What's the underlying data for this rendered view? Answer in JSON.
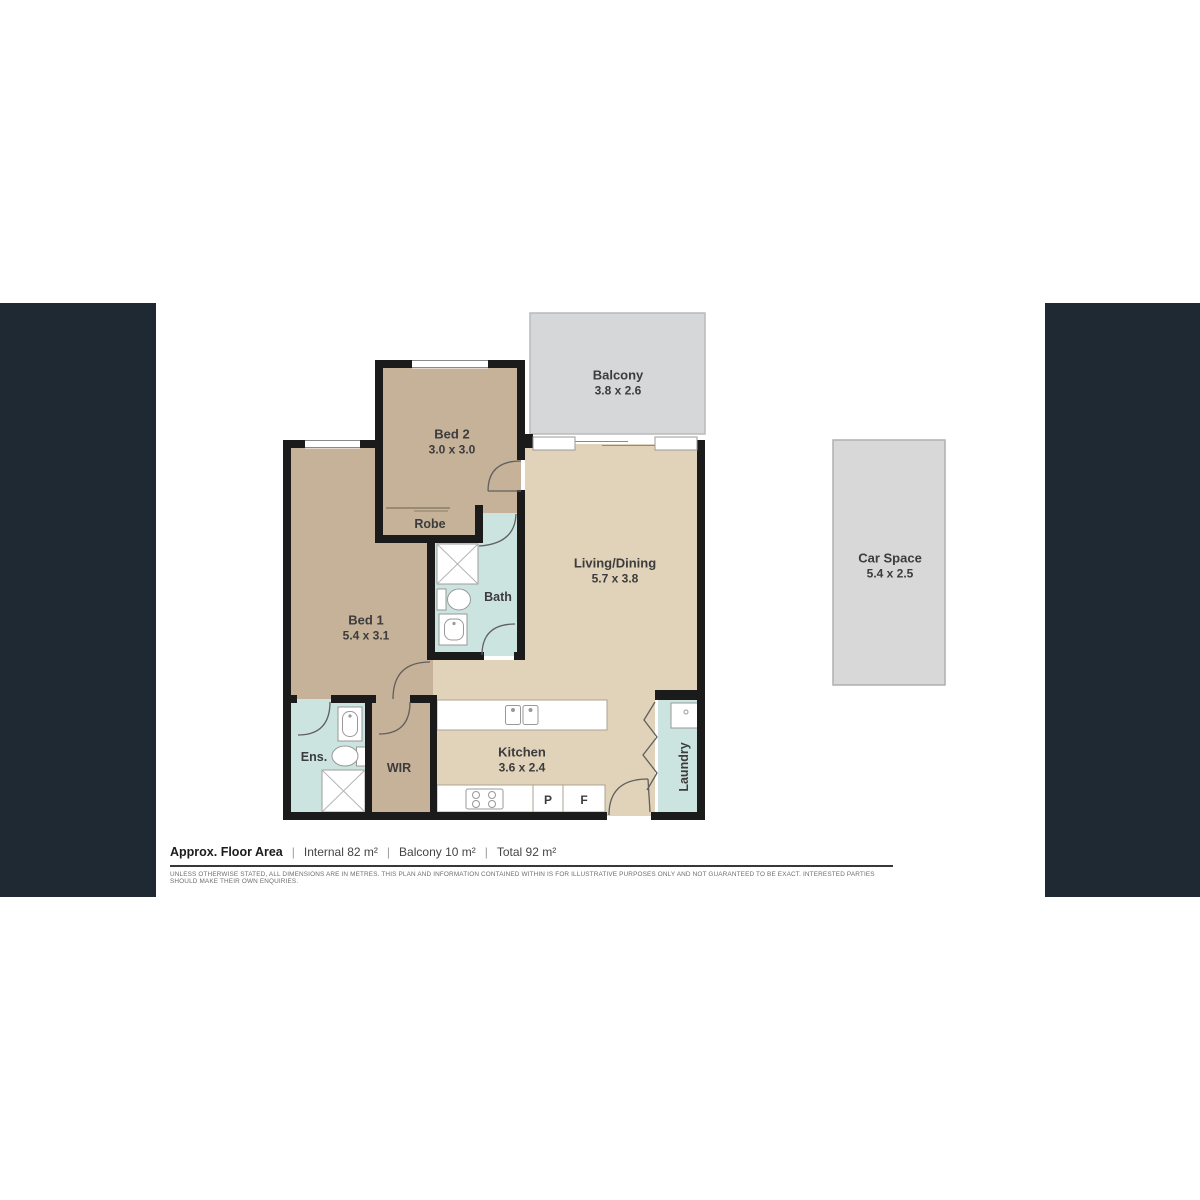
{
  "plan": {
    "rooms": {
      "bed1": {
        "name": "Bed 1",
        "dims": "5.4 x 3.1"
      },
      "bed2": {
        "name": "Bed 2",
        "dims": "3.0 x 3.0"
      },
      "living_dining": {
        "name": "Living/Dining",
        "dims": "5.7 x 3.8"
      },
      "kitchen": {
        "name": "Kitchen",
        "dims": "3.6 x 2.4"
      },
      "balcony": {
        "name": "Balcony",
        "dims": "3.8 x 2.6"
      },
      "car_space": {
        "name": "Car Space",
        "dims": "5.4 x 2.5"
      },
      "bath": {
        "name": "Bath"
      },
      "ensuite": {
        "name": "Ens."
      },
      "wir": {
        "name": "WIR"
      },
      "robe": {
        "name": "Robe"
      },
      "laundry": {
        "name": "Laundry"
      }
    },
    "markers": {
      "pantry": "P",
      "fridge": "F"
    }
  },
  "footer": {
    "label": "Approx. Floor Area",
    "separator": "|",
    "areas": {
      "internal": "Internal 82 m²",
      "balcony": "Balcony 10 m²",
      "total": "Total 92 m²"
    },
    "disclaimer": "UNLESS OTHERWISE STATED, ALL DIMENSIONS ARE IN METRES. THIS PLAN AND INFORMATION CONTAINED WITHIN IS FOR ILLUSTRATIVE PURPOSES ONLY AND NOT GUARANTEED TO BE EXACT. INTERESTED PARTIES SHOULD MAKE THEIR OWN ENQUIRIES."
  },
  "colors": {
    "side_panel": "#1F2933",
    "wall": "#1B1B1B",
    "bedroom_floor": "#C6B199",
    "living_floor": "#E1D2BA",
    "wet_area_floor": "#CCE4E0",
    "outdoor_area": "#D6D7D8",
    "fixture_outline": "#999999"
  }
}
